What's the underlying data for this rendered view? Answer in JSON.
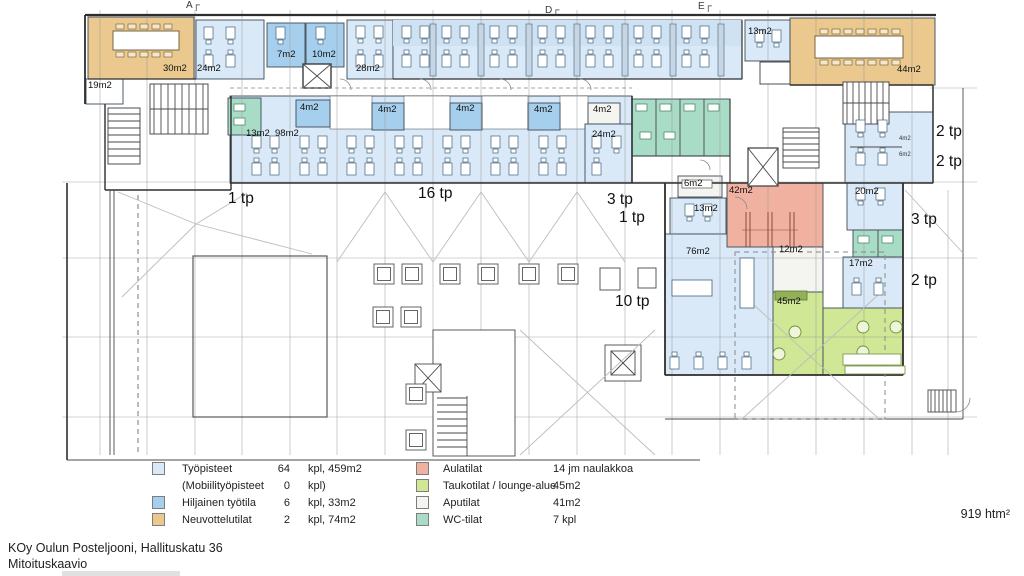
{
  "palette": {
    "tyopisteet": "#d9e9f7",
    "hiljainen": "#a6cfee",
    "neuvottelutilat": "#eac88e",
    "aulatilat": "#f0b1a1",
    "taukotilat": "#d0e795",
    "aputilat": "#f4f4f1",
    "wc_tilat": "#a9dcc6"
  },
  "markers": [
    {
      "t": "A┌",
      "x": 186,
      "y": 1
    },
    {
      "t": "D┌",
      "x": 545,
      "y": 6
    },
    {
      "t": "E┌",
      "x": 698,
      "y": 2
    }
  ],
  "rooms": [
    {
      "t": "30m2",
      "x": 163,
      "y": 64
    },
    {
      "t": "24m2",
      "x": 197,
      "y": 64
    },
    {
      "t": "7m2",
      "x": 277,
      "y": 50
    },
    {
      "t": "10m2",
      "x": 312,
      "y": 50
    },
    {
      "t": "28m2",
      "x": 356,
      "y": 64
    },
    {
      "t": "19m2",
      "x": 88,
      "y": 81
    },
    {
      "t": "13m2",
      "x": 246,
      "y": 129
    },
    {
      "t": "98m2",
      "x": 275,
      "y": 129
    },
    {
      "t": "4m2",
      "x": 300,
      "y": 103
    },
    {
      "t": "4m2",
      "x": 378,
      "y": 105
    },
    {
      "t": "4m2",
      "x": 456,
      "y": 104
    },
    {
      "t": "4m2",
      "x": 534,
      "y": 105
    },
    {
      "t": "4m2",
      "x": 593,
      "y": 105
    },
    {
      "t": "24m2",
      "x": 592,
      "y": 130
    },
    {
      "t": "13m2",
      "x": 748,
      "y": 27
    },
    {
      "t": "44m2",
      "x": 897,
      "y": 65
    },
    {
      "t": "6m2",
      "x": 684,
      "y": 179
    },
    {
      "t": "42m2",
      "x": 729,
      "y": 186
    },
    {
      "t": "13m2",
      "x": 694,
      "y": 204
    },
    {
      "t": "20m2",
      "x": 855,
      "y": 187
    },
    {
      "t": "76m2",
      "x": 686,
      "y": 247
    },
    {
      "t": "12m2",
      "x": 779,
      "y": 245
    },
    {
      "t": "17m2",
      "x": 849,
      "y": 259
    },
    {
      "t": "45m2",
      "x": 777,
      "y": 297
    },
    {
      "t": "4m2",
      "x": 899,
      "y": 136,
      "cls": "small"
    },
    {
      "t": "6m2",
      "x": 899,
      "y": 152,
      "cls": "small"
    }
  ],
  "tp_labels": [
    {
      "t": "1 tp",
      "x": 228,
      "y": 191
    },
    {
      "t": "16 tp",
      "x": 418,
      "y": 186
    },
    {
      "t": "3 tp",
      "x": 607,
      "y": 192
    },
    {
      "t": "1 tp",
      "x": 619,
      "y": 210
    },
    {
      "t": "10 tp",
      "x": 615,
      "y": 294
    },
    {
      "t": "2 tp",
      "x": 936,
      "y": 124
    },
    {
      "t": "2 tp",
      "x": 936,
      "y": 154
    },
    {
      "t": "3 tp",
      "x": 911,
      "y": 212
    },
    {
      "t": "2 tp",
      "x": 911,
      "y": 273
    }
  ],
  "legend": {
    "left": [
      {
        "label": "Työpisteet",
        "count": "64",
        "unit": "kpl, 459m2"
      },
      {
        "label": "(Mobiilityöpisteet",
        "count": "0",
        "unit": "kpl)"
      },
      {
        "label": "Hiljainen työtila",
        "count": "6",
        "unit": "kpl, 33m2"
      },
      {
        "label": "Neuvottelutilat",
        "count": "2",
        "unit": "kpl, 74m2"
      }
    ],
    "right": [
      {
        "label": "Aulatilat",
        "value": "14 jm naulakkoa"
      },
      {
        "label": "Taukotilat / lounge-alue",
        "value": "45m2"
      },
      {
        "label": "Aputilat",
        "value": "41m2"
      },
      {
        "label": "WC-tilat",
        "value": "7   kpl"
      }
    ]
  },
  "footer": {
    "line1": "KOy Oulun Posteljooni, Hallituskatu 36",
    "line2": "Mitoituskaavio"
  },
  "total": "919 htm²"
}
